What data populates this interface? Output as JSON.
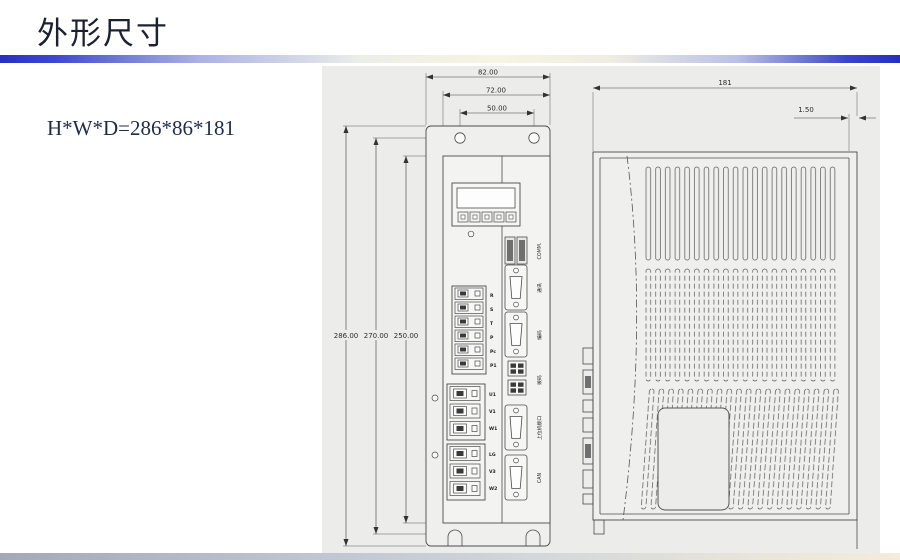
{
  "slide": {
    "title": "外形尺寸",
    "dimension_note": "H*W*D=286*86*181"
  },
  "front_view": {
    "dim_width_outer": "82.00",
    "dim_width_body": "72.00",
    "dim_hole_span": "50.00",
    "dim_height_outer": "286.00",
    "dim_height_mid": "270.00",
    "dim_height_body": "250.00",
    "power_terminals": [
      "R",
      "S",
      "T",
      "P",
      "Pc",
      "P1"
    ],
    "motor_terminals": [
      "U1",
      "V1",
      "W1"
    ],
    "aux_terminals": [
      "LG",
      "V3",
      "W2"
    ],
    "port_labels": [
      "COMM.",
      "通讯",
      "编码",
      "拨码",
      "上位机接口",
      "CAN"
    ]
  },
  "side_view": {
    "dim_depth": "181",
    "dim_plate_thickness": "1.50"
  }
}
